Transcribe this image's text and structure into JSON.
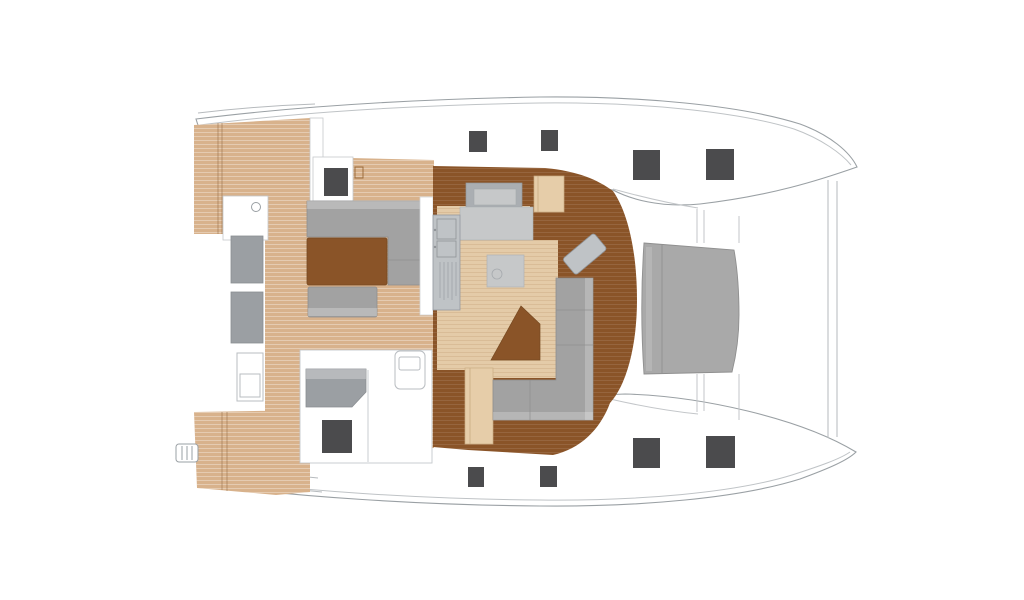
{
  "drawing": {
    "type": "catamaran-deck-floor-plan",
    "view": "top-down",
    "bow_direction": "right",
    "hull_count": 2,
    "deck_hatch_count": 10
  },
  "colors": {
    "background": "#ffffff",
    "hull_fill": "#ffffff",
    "hull_outline": "#9aa0a4",
    "secondary_line": "#bfc3c6",
    "teak_deck": "#d8b28c",
    "saloon_floor_light": "#e4cba8",
    "walnut_floor": "#8a5428",
    "table_wood": "#8a5428",
    "furniture_gray": "#a2a2a2",
    "furniture_gray_light": "#b9b9b9",
    "counter_gray": "#c6c8c9",
    "counter_gray_dark": "#aaaeb2",
    "galley_gray": "#bfc3c6",
    "seat_gray": "#9b9fa3",
    "sunpad_gray": "#a9a9a9",
    "hatch_dark": "#4b4b4d",
    "stairs_tan": "#e6cda9",
    "white_detail": "#ffffff"
  },
  "areas": {
    "bow_sunpad": "sunpad-cushion",
    "foredeck": "white-deck",
    "saloon": "walnut-border-with-light-floor",
    "galley": "gray-counters",
    "cockpit": "teak-floor-with-sofa-table",
    "helm_station": "port-aft-console",
    "transoms": "teak-steps",
    "hulls": "white-deck-with-dark-hatches"
  }
}
